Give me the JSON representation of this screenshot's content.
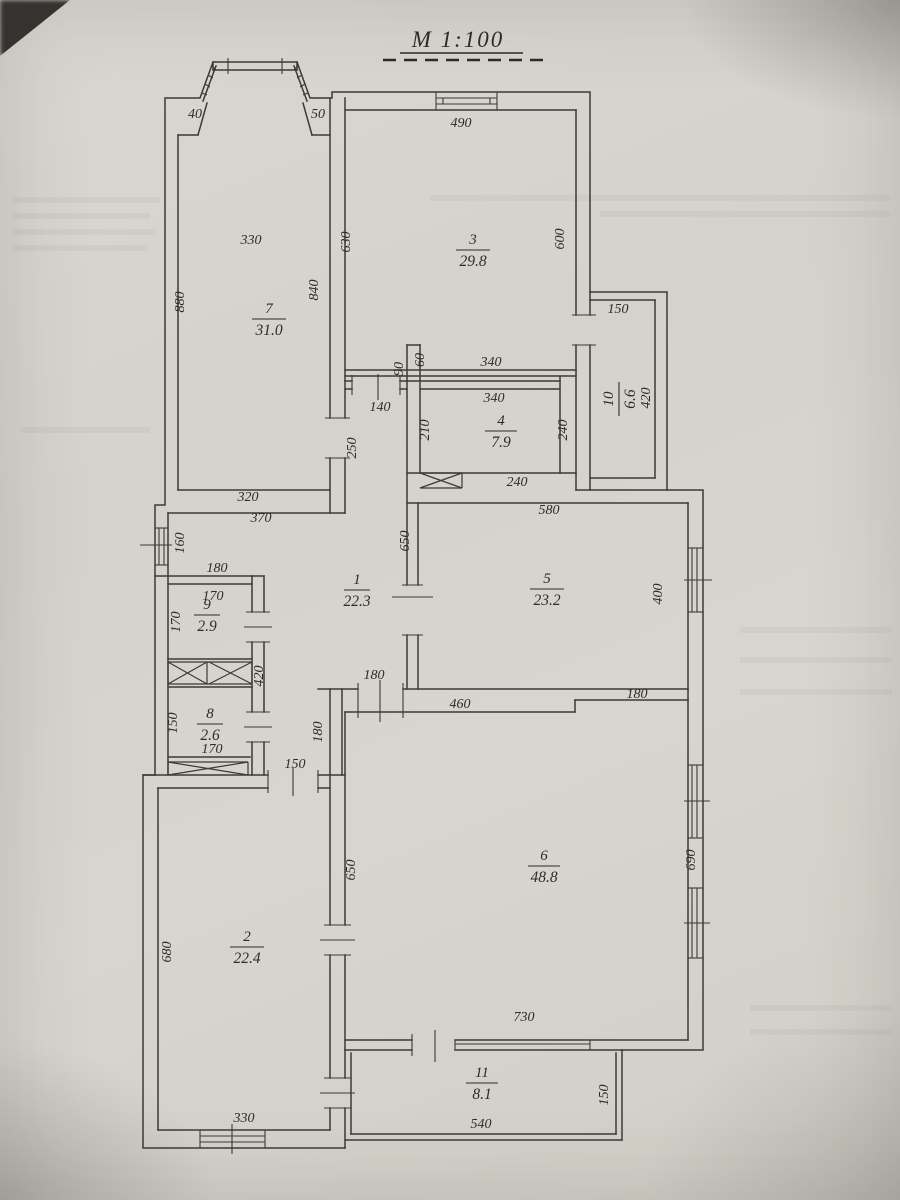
{
  "title": "M 1:100",
  "rooms": [
    {
      "number": "1",
      "area": "22.3"
    },
    {
      "number": "2",
      "area": "22.4"
    },
    {
      "number": "3",
      "area": "29.8"
    },
    {
      "number": "4",
      "area": "7.9"
    },
    {
      "number": "5",
      "area": "23.2"
    },
    {
      "number": "6",
      "area": "48.8"
    },
    {
      "number": "7",
      "area": "31.0"
    },
    {
      "number": "8",
      "area": "2.6"
    },
    {
      "number": "9",
      "area": "2.9"
    },
    {
      "number": "10",
      "area": "6.6"
    },
    {
      "number": "11",
      "area": "8.1"
    }
  ],
  "dimensions": [
    {
      "value": "40"
    },
    {
      "value": "50"
    },
    {
      "value": "490"
    },
    {
      "value": "330"
    },
    {
      "value": "630"
    },
    {
      "value": "880"
    },
    {
      "value": "840"
    },
    {
      "value": "600"
    },
    {
      "value": "150"
    },
    {
      "value": "420"
    },
    {
      "value": "90"
    },
    {
      "value": "60"
    },
    {
      "value": "340"
    },
    {
      "value": "340"
    },
    {
      "value": "140"
    },
    {
      "value": "210"
    },
    {
      "value": "240"
    },
    {
      "value": "240"
    },
    {
      "value": "250"
    },
    {
      "value": "320"
    },
    {
      "value": "370"
    },
    {
      "value": "160"
    },
    {
      "value": "650"
    },
    {
      "value": "580"
    },
    {
      "value": "180"
    },
    {
      "value": "170"
    },
    {
      "value": "170"
    },
    {
      "value": "400"
    },
    {
      "value": "420"
    },
    {
      "value": "150"
    },
    {
      "value": "170"
    },
    {
      "value": "150"
    },
    {
      "value": "180"
    },
    {
      "value": "180"
    },
    {
      "value": "460"
    },
    {
      "value": "180"
    },
    {
      "value": "650"
    },
    {
      "value": "680"
    },
    {
      "value": "690"
    },
    {
      "value": "730"
    },
    {
      "value": "330"
    },
    {
      "value": "540"
    },
    {
      "value": "150"
    }
  ]
}
